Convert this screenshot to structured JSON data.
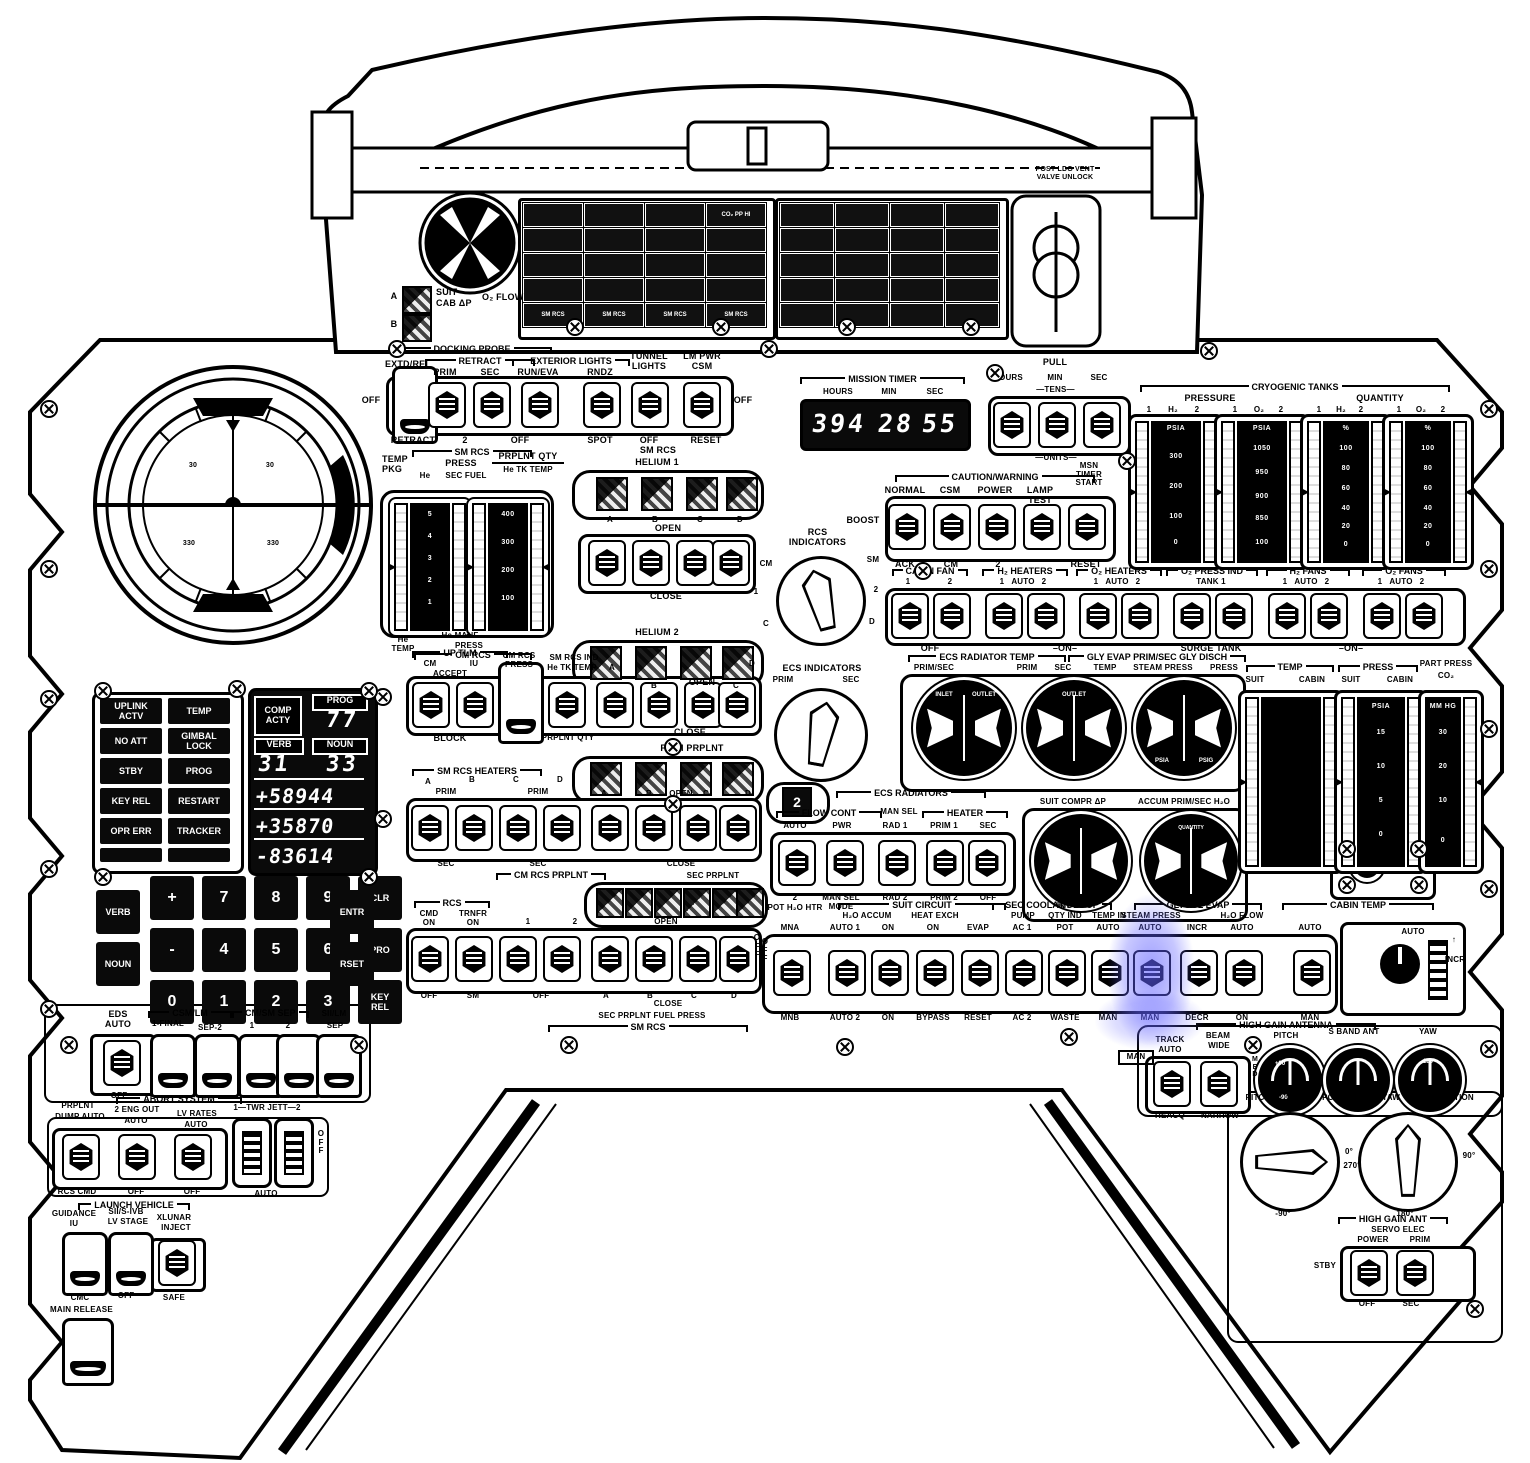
{
  "top": {
    "post_ldg": "POST LDG VENT\nVALVE UNLOCK",
    "suit": {
      "a": "A",
      "b": "B",
      "l1": "SUIT",
      "l2": "CAB ΔP",
      "l3": "O₂ FLOW"
    },
    "breaker_left_row5": [
      "SM RCS",
      "SM RCS",
      "SM RCS",
      "SM RCS"
    ],
    "co2": "CO₂ PP HI"
  },
  "docking": {
    "title": "DOCKING PROBE",
    "retract": "RETRACT",
    "ext": "EXTERIOR LIGHTS",
    "extd": "EXTD/REL",
    "prim": "PRIM",
    "sec": "SEC",
    "runeva": "RUN/EVA",
    "rndz": "RNDZ",
    "tunnel": "TUNNEL\nLIGHTS",
    "lmpwr": "LM PWR\nCSM",
    "off_l": "OFF",
    "b0": "RETRACT",
    "b1": "2",
    "b2": "OFF",
    "b3": "SPOT",
    "b4": "OFF",
    "b5": "RESET",
    "off_r": "OFF"
  },
  "timer": {
    "title": "MISSION TIMER",
    "hours": "HOURS",
    "min": "MIN",
    "sec": "SEC",
    "d_hours": "394",
    "d_min": "28",
    "d_sec": "55",
    "pull": "PULL",
    "tens": "—TENS—",
    "units": "—UNITS—"
  },
  "cryo": {
    "title": "CRYOGENIC TANKS",
    "pressure": "PRESSURE",
    "quantity": "QUANTITY",
    "c0": "1",
    "c1": "H₂",
    "c2": "2",
    "c3": "1",
    "c4": "O₂",
    "c5": "2",
    "c6": "1",
    "c7": "H₂",
    "c8": "2",
    "c9": "1",
    "c10": "O₂",
    "c11": "2",
    "t1": [
      "PSIA",
      "300",
      "200",
      "100",
      "0"
    ],
    "t2": [
      "PSIA",
      "1050",
      "950",
      "900",
      "850",
      "100"
    ],
    "t3": [
      "%",
      "100",
      "80",
      "60",
      "40",
      "20",
      "0"
    ],
    "t4": [
      "%",
      "100",
      "80",
      "60",
      "40",
      "20",
      "0"
    ]
  },
  "caution": {
    "boost": "BOOST",
    "title": "CAUTION/WARNING",
    "normal": "NORMAL",
    "csm": "CSM",
    "power": "POWER",
    "lamp": "LAMP TEST",
    "msn": "MSN\nTIMER\nSTART",
    "ack": "ACK",
    "cm": "CM",
    "two": "2",
    "reset": "RESET"
  },
  "ecsrow": {
    "g0": "CABIN FAN",
    "g1": "H₂ HEATERS",
    "g2": "O₂ HEATERS",
    "g3": "O₂ PRESS IND",
    "g4": "H₂ FANS",
    "g5": "O₂ FANS",
    "s0": "1",
    "s1": "2",
    "s2": "1",
    "s3": "AUTO",
    "s4": "2",
    "s5": "1",
    "s6": "AUTO",
    "s7": "2",
    "s8": "TANK 1",
    "s9": "1",
    "s10": "AUTO",
    "s11": "2",
    "s12": "1",
    "s13": "AUTO",
    "s14": "2",
    "b0": "OFF",
    "b1": "–ON–",
    "b2": "SURGE TANK",
    "b3": "–ON–"
  },
  "rcsind": {
    "title": "RCS\nINDICATORS",
    "p0": "CM",
    "p1": "SM",
    "p2": "1",
    "p3": "2",
    "p4": "C",
    "p5": "D"
  },
  "ecsind": {
    "title": "ECS INDICATORS",
    "prim": "PRIM",
    "sec": "SEC"
  },
  "fdai": {
    "a": "30",
    "b": "30",
    "c": "330",
    "d": "330"
  },
  "smtapes": {
    "pkg": "TEMP\nPKG",
    "smrcs": "SM RCS",
    "press": "PRESS",
    "he": "He",
    "secfuel": "SEC FUEL",
    "qty": "PRPLNT QTY",
    "tktemp": "He TK TEMP",
    "lt": [
      "5",
      "4",
      "3",
      "2",
      "1"
    ],
    "rt": [
      "400",
      "300",
      "200",
      "100"
    ],
    "hetemp": "He\nTEMP",
    "manf": "He MANF",
    "press2": "PRESS",
    "cmrcs": "CM RCS"
  },
  "he1": {
    "t1": "SM RCS",
    "t2": "HELIUM 1",
    "a": "A",
    "b": "B",
    "c": "C",
    "d": "D",
    "open": "OPEN",
    "close": "CLOSE"
  },
  "he2": {
    "t": "HELIUM 2",
    "open": "OPEN",
    "a": "A",
    "b": "B",
    "c": "C",
    "d": "D",
    "close": "CLOSE",
    "prim": "PRIM PRPLNT"
  },
  "uptlm": {
    "t": "UP TLM",
    "cm": "CM",
    "iu": "IU",
    "accept": "ACCEPT",
    "cmrcs": "CM RCS\nPRESS",
    "ind1": "SM RCS IND",
    "ind2": "He TK TEMP",
    "a": "A",
    "block": "BLOCK",
    "qty": "PRPLNT QTY"
  },
  "heaters": {
    "t": "SM RCS HEATERS",
    "a": "A",
    "b": "B",
    "c": "C",
    "d": "D",
    "prim1": "PRIM",
    "prim2": "PRIM",
    "sec1": "SEC",
    "sec2": "SEC",
    "ra": "A",
    "rb": "B",
    "rc": "C",
    "rd": "D",
    "open": "OPEN",
    "close": "CLOSE",
    "secp": "SEC PRPLNT"
  },
  "cmprplnt": "CM RCS PRPLNT",
  "rcsrow": {
    "t": "RCS",
    "cmd": "CMD\nON",
    "trnfr": "TRNFR\nON",
    "one": "1",
    "two": "2",
    "open": "OPEN",
    "off1": "OFF",
    "sm": "SM",
    "off2": "OFF",
    "a": "A",
    "b": "B",
    "c": "C",
    "d": "D",
    "close": "CLOSE",
    "fuel": "SEC PRPLNT FUEL PRESS",
    "smrcs": "SM RCS",
    "offr": "O\nF\nF"
  },
  "radtemp": {
    "t": "ECS RADIATOR TEMP",
    "primsec": "PRIM/SEC",
    "prim": "PRIM",
    "sec": "SEC",
    "inlet": "INLET",
    "outlet": "OUTLET"
  },
  "gly": {
    "t": "GLY EVAP  PRIM/SEC  GLY DISCH",
    "temp": "TEMP",
    "steam": "STEAM PRESS",
    "press": "PRESS",
    "psia": "PSIA",
    "psig": "PSIG"
  },
  "ecsrad": {
    "tb": "2",
    "t": "ECS RADIATORS",
    "flow": "FLOW CONT",
    "man": "MAN SEL",
    "heat": "HEATER",
    "t0": "AUTO",
    "t1": "PWR",
    "t2": "RAD 1",
    "t3": "PRIM 1",
    "t4": "SEC",
    "b0": "2",
    "b1": "MAN SEL\nMODE",
    "b2": "RAD 2",
    "b3": "PRIM 2",
    "b4": "OFF"
  },
  "suitaccum": {
    "suit": "SUIT COMPR ΔP",
    "accum": "ACCUM PRIM/SEC H₂O",
    "qty": "QUANTITY"
  },
  "rtapes": {
    "temp": "TEMP",
    "suit1": "SUIT",
    "cabin1": "CABIN",
    "press": "PRESS",
    "suit2": "SUIT",
    "cabin2": "CABIN",
    "part": "PART PRESS",
    "co2": "CO₂",
    "pt": [
      "PSIA",
      "15",
      "10",
      "5",
      "0"
    ],
    "ct": [
      "MM HG",
      "30",
      "20",
      "10",
      "0"
    ]
  },
  "brow": {
    "off": "O\nF\nF",
    "pot": "POT H₂O HTR",
    "suitc": "SUIT CIRCUIT",
    "accum": "H₂O ACCUM",
    "hx": "HEAT EXCH",
    "loop": "SEC COOLANT LOOP",
    "pump": "PUMP",
    "h2o": "H₂O",
    "qtyind": "QTY IND",
    "tempin": "TEMP IN",
    "glycol": "GLYCOL EVAP",
    "steam": "STEAM PRESS",
    "flow": "H₂O FLOW",
    "top": [
      "MNA",
      "AUTO 1",
      "ON",
      "ON",
      "EVAP",
      "AC 1",
      "POT",
      "AUTO",
      "AUTO",
      "INCR",
      "AUTO",
      "AUTO"
    ],
    "bot": [
      "MNB",
      "AUTO 2",
      "ON",
      "BYPASS",
      "RESET",
      "AC 2",
      "WASTE",
      "MAN",
      "MAN",
      "DECR",
      "ON",
      "MAN"
    ]
  },
  "cabint": {
    "t": "CABIN TEMP",
    "auto": "AUTO",
    "incr": "INCR",
    "arrow": "↑"
  },
  "hga": {
    "t": "HIGH GAIN ANTENNA",
    "pitch": "PITCH",
    "sband": "S BAND ANT",
    "yaw": "YAW",
    "track": "TRACK",
    "auto": "AUTO",
    "beam": "BEAM",
    "wide": "WIDE",
    "man": "MAN",
    "med": "M\nE\nD",
    "reacq": "REACQ",
    "narrow": "NARROW",
    "p90": "+90",
    "p0": "0",
    "pm90": "-90",
    "y180": "180",
    "pp": {
      "a": "PITCH",
      "b": "+90°",
      "c": "POSITION",
      "r0": "0°",
      "r270": "270°",
      "bm": "-90°"
    },
    "yp": {
      "a": "YAW",
      "b": "0°",
      "c": "POSITION",
      "r90": "90°",
      "b180": "180°"
    },
    "servo": {
      "a": "HIGH GAIN ANT",
      "b": "SERVO ELEC",
      "power": "POWER",
      "prim": "PRIM",
      "stby": "STBY",
      "off": "OFF",
      "sec": "SEC"
    }
  },
  "eds": {
    "t": "EDS\nAUTO",
    "off": "OFF"
  },
  "seps": {
    "csmlm": "CSM/LM",
    "final": "1-FINAL",
    "sep2": "SEP-2",
    "cmsm": "CM/SM SEP",
    "one": "1",
    "two": "2",
    "sii": "SII/LM",
    "sep": "SEP"
  },
  "abort": {
    "t": "ABORT SYSTEM",
    "prplnt": "PRPLNT",
    "dump": "DUMP AUTO",
    "rcscmd": "RCS CMD",
    "eng": "2 ENG OUT",
    "auto1": "AUTO",
    "off1": "OFF",
    "lv": "LV RATES",
    "auto2": "AUTO",
    "off2": "OFF",
    "twr": "1—TWR JETT—2",
    "off": "O\nF\nF",
    "auto3": "AUTO"
  },
  "lv": {
    "t": "LAUNCH VEHICLE",
    "guid": "GUIDANCE",
    "iu": "IU",
    "cmc": "CMC",
    "sii": "SII/S-IVB",
    "stage": "LV STAGE",
    "off": "OFF",
    "xl": "XLUNAR",
    "inject": "INJECT",
    "safe": "SAFE",
    "main": "MAIN RELEASE"
  },
  "dsky": {
    "lights": [
      "UPLINK\nACTV",
      "TEMP",
      "NO ATT",
      "GIMBAL\nLOCK",
      "STBY",
      "PROG",
      "KEY REL",
      "RESTART",
      "OPR ERR",
      "TRACKER"
    ],
    "comp": "COMP\nACTY",
    "progl": "PROG",
    "prog": "77",
    "verbl": "VERB",
    "verb": "31",
    "nounl": "NOUN",
    "noun": "33",
    "r1": "+58944",
    "r2": "+35870",
    "r3": "-83614",
    "keys": [
      "VERB",
      "NOUN",
      "+",
      "7",
      "8",
      "9",
      "CLR",
      "-",
      "4",
      "5",
      "6",
      "PRO",
      "0",
      "1",
      "2",
      "3",
      "KEY\nREL",
      "ENTR",
      "RSET"
    ]
  }
}
